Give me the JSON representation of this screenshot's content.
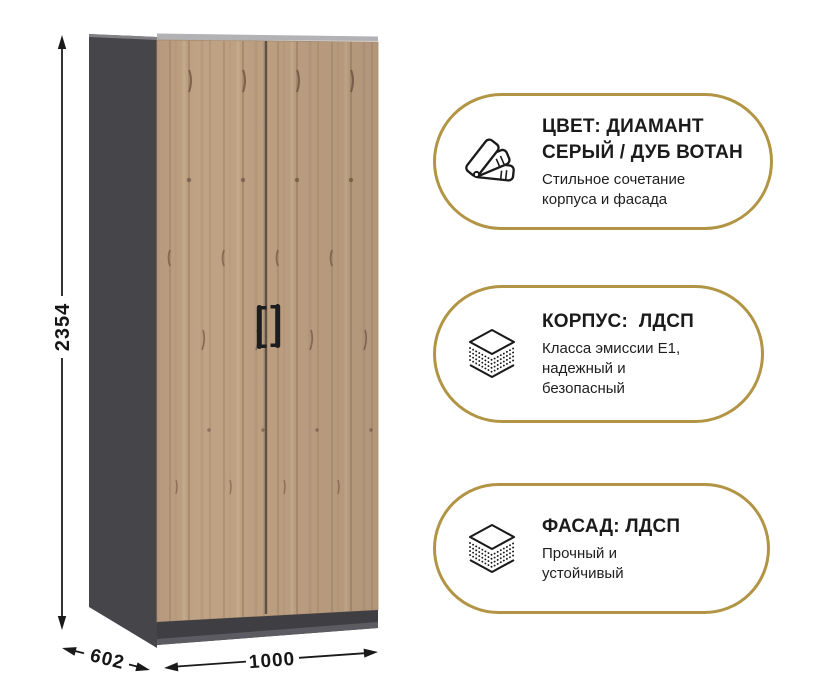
{
  "dimensions": {
    "height": "2354",
    "depth": "602",
    "width": "1000"
  },
  "badges": [
    {
      "icon": "color-swatches-icon",
      "title": "ЦВЕТ: ДИАМАНТ СЕРЫЙ / ДУБ ВОТАН",
      "subtitle": "Стильное сочетание корпуса и фасада"
    },
    {
      "icon": "layers-icon",
      "title": "КОРПУС:  ЛДСП",
      "subtitle": "Класса эмиссии Е1, надежный и безопасный"
    },
    {
      "icon": "layers-icon",
      "title": "ФАСАД: ЛДСП",
      "subtitle": "Прочный и устойчивый"
    }
  ],
  "colors": {
    "accent_gold": "#b29544",
    "carcass_gray": "#45454a",
    "wood_watan_oak": "#c0a284",
    "text": "#1b1b1b"
  }
}
